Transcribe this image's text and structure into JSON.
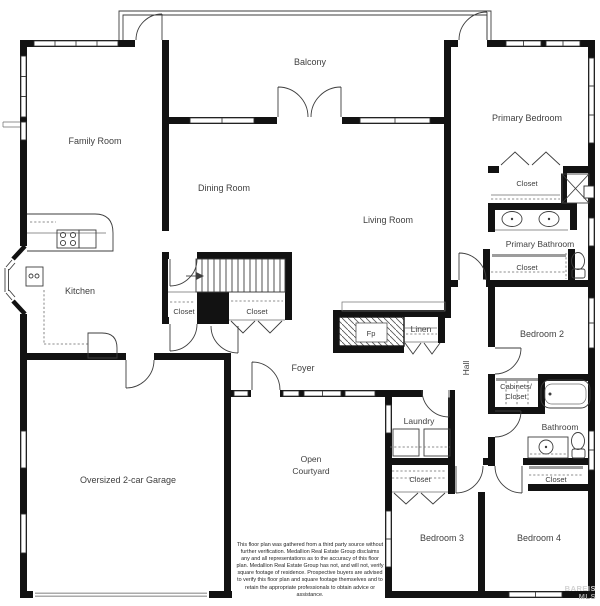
{
  "floor_plan": {
    "labels": {
      "balcony": "Balcony",
      "family_room": "Family Room",
      "dining_room": "Dining Room",
      "living_room": "Living Room",
      "primary_bedroom": "Primary Bedroom",
      "primary_bathroom": "Primary Bathroom",
      "kitchen": "Kitchen",
      "bedroom_2": "Bedroom 2",
      "bedroom_3": "Bedroom 3",
      "bedroom_4": "Bedroom 4",
      "foyer": "Foyer",
      "hall": "Hall",
      "laundry": "Laundry",
      "bathroom": "Bathroom",
      "linen": "Linen",
      "fireplace": "Fp",
      "closet": "Closet",
      "cabinets_closet_line1": "Cabinets/",
      "cabinets_closet_line2": "Closet",
      "open_courtyard_line1": "Open",
      "open_courtyard_line2": "Courtyard",
      "garage": "Oversized 2-car Garage"
    },
    "colors": {
      "wall": "#121212",
      "line": "#3d3d3d",
      "label_text": "#3f3f3f",
      "slider_track": "#9c9c9c",
      "background": "#ffffff"
    }
  },
  "disclaimer": {
    "text": "This floor plan was gathered from a third party source without further verification. Medallion Real Estate Group disclaims any and all representations as to the accuracy of this floor plan.  Medallion Real Estate Group has not, and will not, verify square footage of residence. Prospective buyers are advised to verify this floor plan and square footage themselves and to retain the appropriate professionals to obtain advice or assistance."
  },
  "watermark": {
    "line1": "BAREIS",
    "line2": "MLS"
  }
}
